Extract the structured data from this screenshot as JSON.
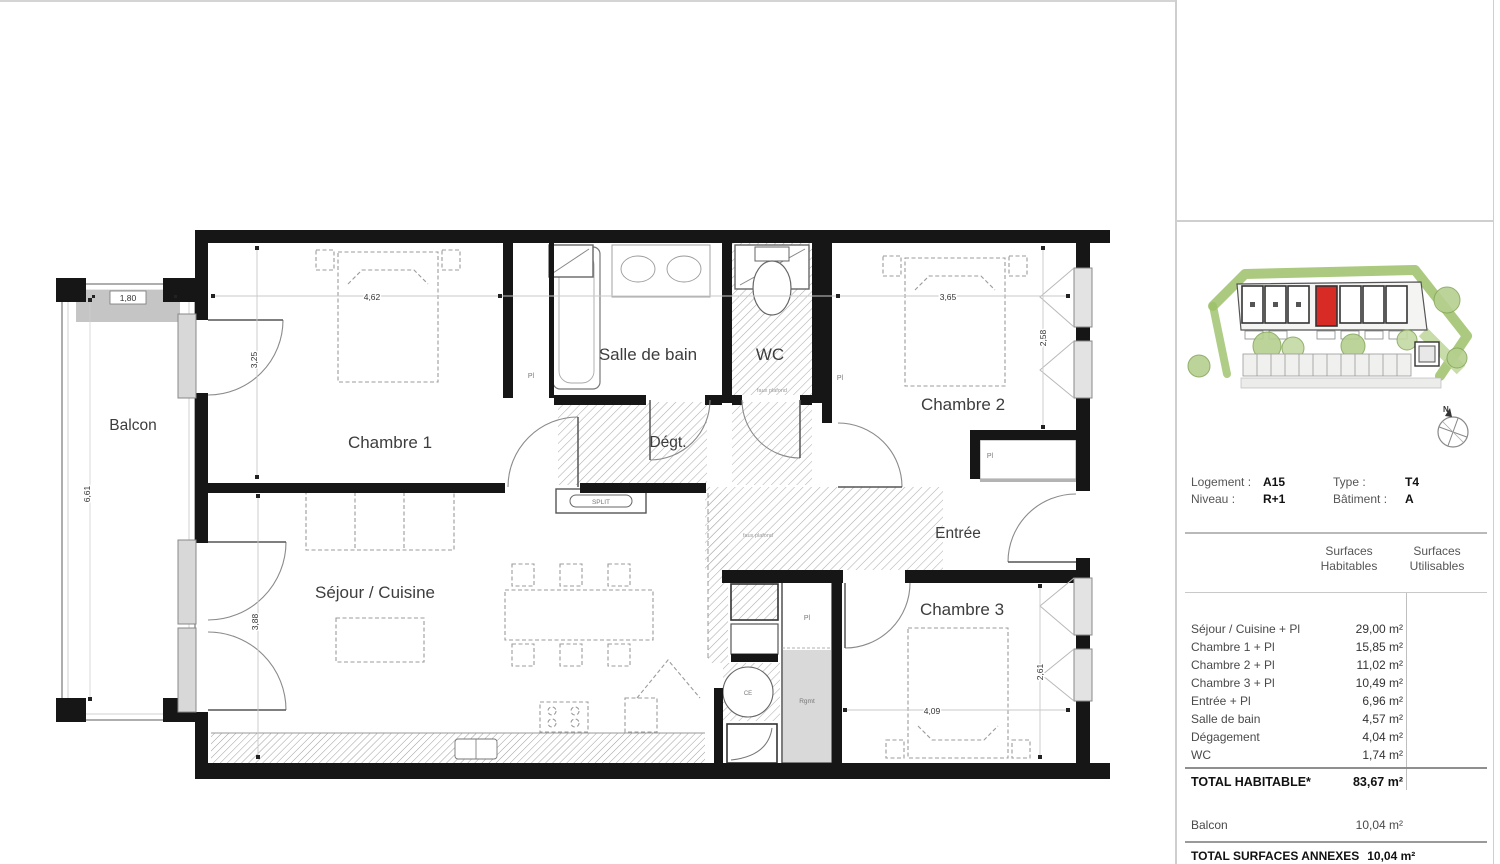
{
  "plan": {
    "rooms": {
      "balcon": "Balcon",
      "chambre1": "Chambre 1",
      "salle_de_bain": "Salle de bain",
      "wc": "WC",
      "chambre2": "Chambre 2",
      "degt": "Dégt.",
      "entree": "Entrée",
      "sejour": "Séjour / Cuisine",
      "chambre3": "Chambre 3"
    },
    "dimensions": {
      "balcon_w": "1,80",
      "balcon_h": "6,61",
      "ch1_w": "4,62",
      "ch1_h": "3,25",
      "sejour_h": "3,88",
      "ch2_w": "3,65",
      "ch2_h": "2,58",
      "ch3_w": "4,09",
      "ch3_h": "2,61"
    },
    "annotations": {
      "split": "SPLIT",
      "pl": "Pl",
      "ce": "CE",
      "rgmt": "Rgmt",
      "faux_plafond": "faux plafond"
    }
  },
  "sidebar": {
    "compass": {
      "north": "N"
    },
    "unit": {
      "logement_label": "Logement :",
      "logement_value": "A15",
      "niveau_label": "Niveau :",
      "niveau_value": "R+1",
      "type_label": "Type :",
      "type_value": "T4",
      "batiment_label": "Bâtiment :",
      "batiment_value": "A"
    },
    "surfaces": {
      "col1_header_line1": "Surfaces",
      "col1_header_line2": "Habitables",
      "col2_header_line1": "Surfaces",
      "col2_header_line2": "Utilisables",
      "rows": [
        {
          "label": "Séjour / Cuisine + Pl",
          "value": "29,00 m²"
        },
        {
          "label": "Chambre 1 + Pl",
          "value": "15,85 m²"
        },
        {
          "label": "Chambre 2 + Pl",
          "value": "11,02 m²"
        },
        {
          "label": "Chambre 3 + Pl",
          "value": "10,49 m²"
        },
        {
          "label": "Entrée + Pl",
          "value": "6,96 m²"
        },
        {
          "label": "Salle de bain",
          "value": "4,57 m²"
        },
        {
          "label": "Dégagement",
          "value": "4,04 m²"
        },
        {
          "label": "WC",
          "value": "1,74 m²"
        }
      ],
      "total_label": "TOTAL HABITABLE*",
      "total_value": "83,67 m²"
    },
    "annexes": {
      "balcon_label": "Balcon",
      "balcon_value": "10,04 m²",
      "total_label": "TOTAL SURFACES ANNEXES",
      "total_value": "10,04 m²"
    }
  }
}
